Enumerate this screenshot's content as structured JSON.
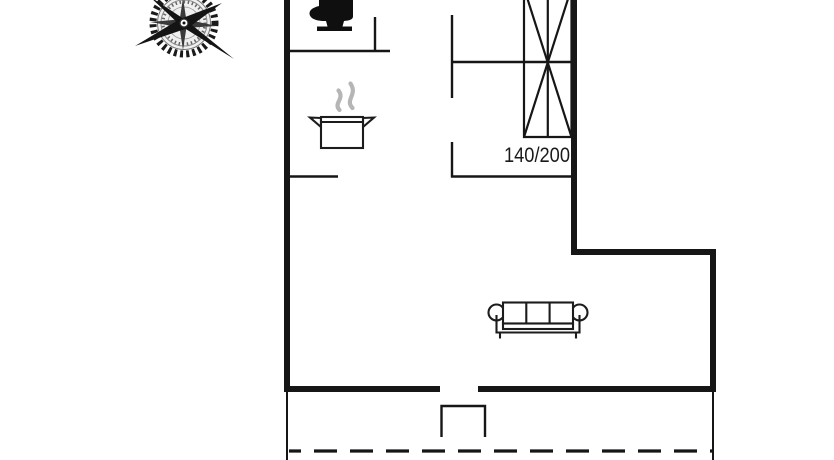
{
  "floorplan": {
    "bed_size_label": "140/200",
    "icons": {
      "orientation": "compass-rose-icon",
      "bathroom": "toilet-icon",
      "kitchen": "steaming-pot-icon",
      "bedroom": "double-bed-crossed-icon",
      "living_room": "three-seat-sofa-icon",
      "entrance": "door-step",
      "terrace_edge": "dashed-boundary-line"
    },
    "colors": {
      "background": "#ffffff",
      "wall": "#161616",
      "furniture_line": "#1c1c1c",
      "steam_gray": "#b5b5b5",
      "label_text": "#1a1a1a"
    }
  }
}
